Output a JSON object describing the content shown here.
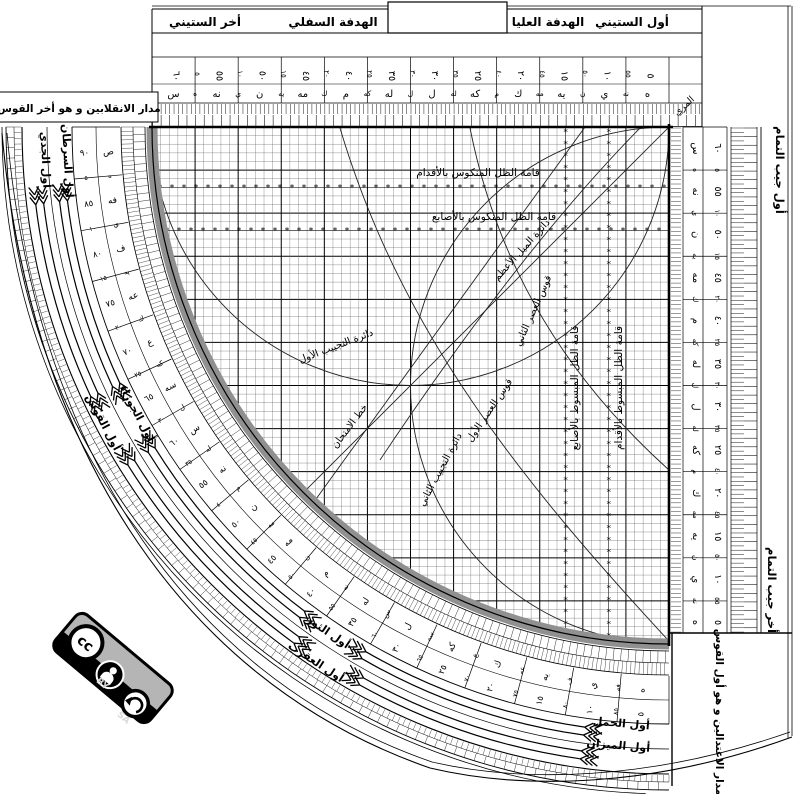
{
  "header": {
    "akhar_sittini": "أخر الستيني",
    "hadafa_sufla": "الهدفة السفلي",
    "hadafa_ulya": "الهدفة العليا",
    "awwal_sittini": "أول الستيني",
    "muri": "المري"
  },
  "corners": {
    "solstice": "مدار الانقلابين و هو أخر القوس",
    "equinox": "مدار الاعتدالين و هو أول القوس"
  },
  "cosine_edge": {
    "start": "أول جيب التمام",
    "end": "أخر جيب التمام"
  },
  "grid_labels": {
    "reversed_shadow_feet": "قامة الظل المنكوس بالأقدام",
    "reversed_shadow_digits": "قامة الظل المنكوس بالأصابع",
    "extended_shadow_digits": "قامة الظل المبسوط بالأصابع",
    "extended_shadow_feet": "قامة الظل المبسوط بالأقدام",
    "max_declination": "دائرة الميل الأعظم",
    "asr_second": "قوس العصر الثاني",
    "asr_first": "قوس العصر الأول",
    "test_line": "خط الامتحان",
    "sine_circle_first": "دائرة التجييب الأول",
    "sine_circle_second": "دائرة التجييب الثاني"
  },
  "zodiac": {
    "capricorn": "أول الجدي",
    "cancer": "أول السرطان",
    "sagittarius": "أول القوس",
    "gemini": "أول الجوزاء",
    "scorpio": "أول العقرب",
    "taurus": "أول الثور",
    "libra": "أول الميزان",
    "aries": "أول الحمل"
  },
  "scales": {
    "values_5_60": [
      "٥",
      "١٠",
      "١٥",
      "٢٠",
      "٢٥",
      "٣٠",
      "٣٥",
      "٤٠",
      "٤٥",
      "٥٠",
      "٥٥",
      "٦٠"
    ],
    "abjad_5_60": [
      "ه",
      "ي",
      "يه",
      "ك",
      "كه",
      "ل",
      "له",
      "م",
      "مه",
      "ن",
      "نه",
      "س"
    ],
    "arc_values_90_5": [
      "٩٠",
      "٨٥",
      "٨٠",
      "٧٥",
      "٧٠",
      "٦٥",
      "٦٠",
      "٥٥",
      "٥٠",
      "٤٥",
      "٤٠",
      "٣٥",
      "٣٠",
      "٢٥",
      "٢٠",
      "١٥",
      "١٠",
      "٥"
    ],
    "arc_abjad_90_5": [
      "ص",
      "فه",
      "ف",
      "عه",
      "ع",
      "سه",
      "س",
      "نه",
      "ن",
      "مه",
      "م",
      "له",
      "ل",
      "كه",
      "ك",
      "يه",
      "ي",
      "ه"
    ]
  },
  "license": {
    "cc": "cc",
    "by": "BY",
    "sa": "SA"
  },
  "colors": {
    "ink": "#000000",
    "limb_gray": "#909090",
    "badge_gray": "#b5b5b5",
    "paper": "#ffffff"
  }
}
